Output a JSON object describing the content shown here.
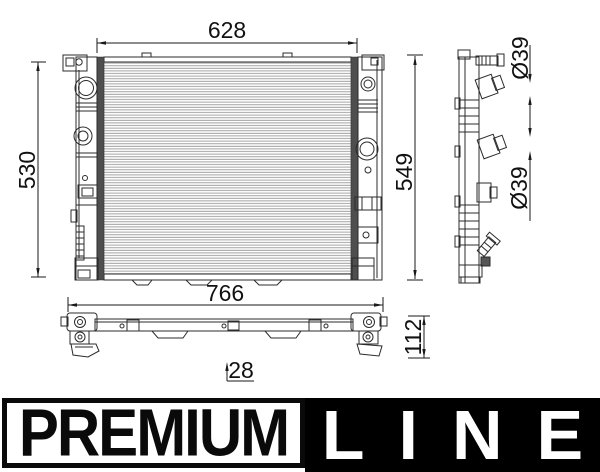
{
  "diagram": {
    "line_color": "#2b2b2b",
    "dim_color": "#1a1a1a",
    "fin_color": "#9a9a9a",
    "tank_strip_color": "#4e4e4e",
    "dimensions": {
      "front_width": "628",
      "front_core_height": "530",
      "front_overall_height": "549",
      "port_top_diameter": "Ø39",
      "port_bottom_diameter": "Ø39",
      "bottom_width": "766",
      "bottom_height": "112",
      "bottom_depth": "28"
    }
  },
  "banner": {
    "premium_label": "PREMIUM",
    "line_label": "LINE",
    "premium_bg": "#ffffff",
    "premium_fg": "#0a0a0a",
    "line_bg": "#000000",
    "line_fg": "#ffffff"
  }
}
